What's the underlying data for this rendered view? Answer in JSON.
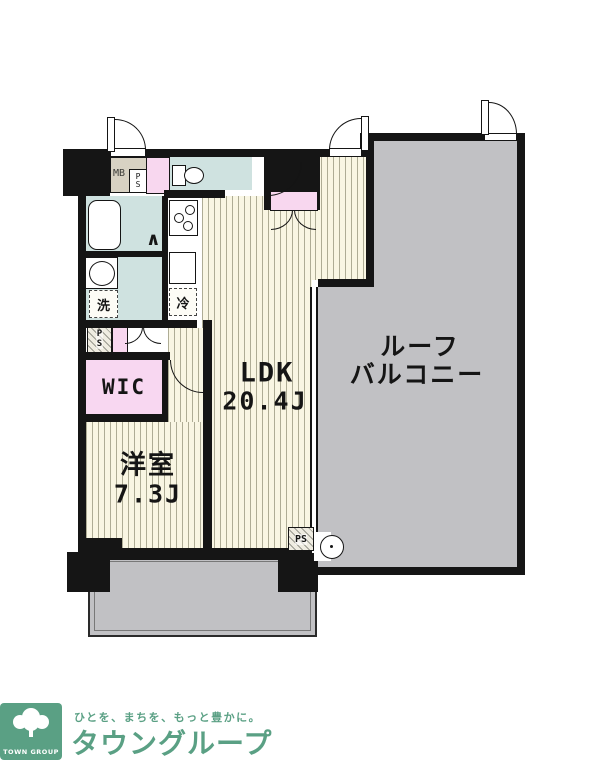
{
  "plan": {
    "labels": {
      "ldk_name": "LDK",
      "ldk_size": "20.4J",
      "western_name": "洋室",
      "western_size": "7.3J",
      "wic": "WIC",
      "roof_balcony_line1": "ルーフ",
      "roof_balcony_line2": "バルコニー"
    },
    "fixtures": {
      "meter_box": "MB",
      "meter_ps_p": "P",
      "meter_ps_s": "S",
      "hall_ps_p": "P",
      "hall_ps_s": "S",
      "balcony_ps": "PS",
      "washing_machine": "洗",
      "refrigerator": "冷",
      "bath_door_symbol": "∧"
    }
  },
  "footer": {
    "logo_caption": "TOWN GROUP",
    "tagline": "ひとを、まちを、もっと豊かに。",
    "brand": "タウングループ"
  },
  "colors": {
    "wall": "#151515",
    "floor_bg": "#f9f6e3",
    "wet_area_blue": "#cfe2e0",
    "accent_pink": "#f8d7ef",
    "balcony_gray": "#c1c1c4",
    "meter_box_tan": "#d8d2c3",
    "brand_green": "#5aa084"
  }
}
